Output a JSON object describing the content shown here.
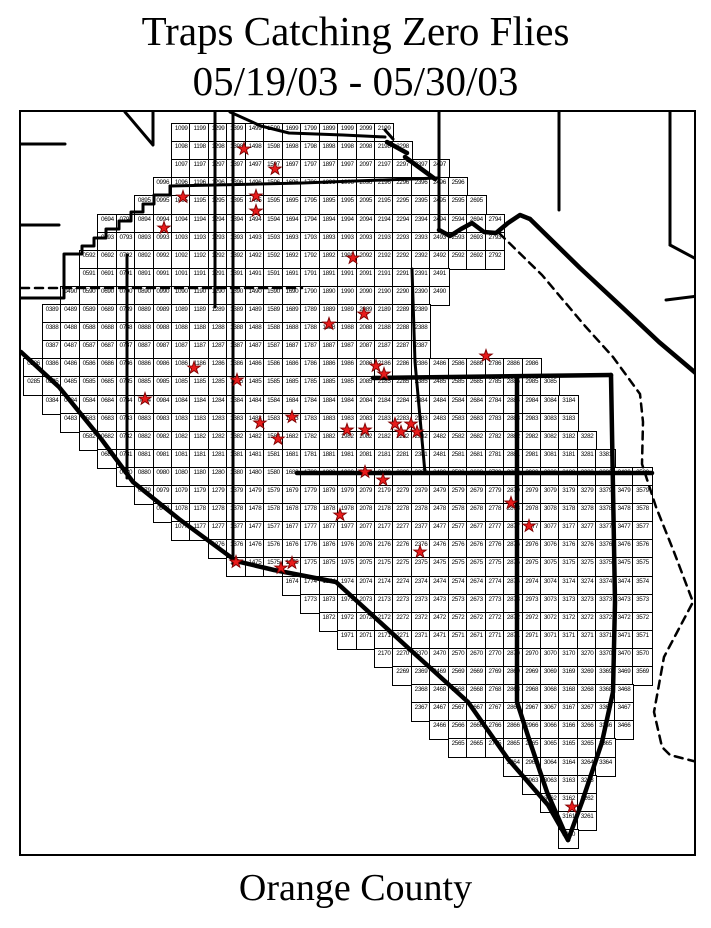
{
  "title": {
    "line1": "Traps Catching Zero Flies",
    "line2": "05/19/03 - 05/30/03"
  },
  "footer": {
    "county_label": "Orange County"
  },
  "colors": {
    "background": "#ffffff",
    "line": "#000000",
    "cell_border": "#000000",
    "star_fill": "#e81b1b",
    "star_stroke": "#7e0000"
  },
  "map": {
    "grid": {
      "rows": [
        {
          "row": 99,
          "col_start": 10,
          "col_end": 21
        },
        {
          "row": 98,
          "col_start": 10,
          "col_end": 22
        },
        {
          "row": 97,
          "col_start": 10,
          "col_end": 24
        },
        {
          "row": 96,
          "col_start": 9,
          "col_end": 25
        },
        {
          "row": 95,
          "col_start": 8,
          "col_end": 26
        },
        {
          "row": 94,
          "col_start": 6,
          "col_end": 27
        },
        {
          "row": 93,
          "col_start": 6,
          "col_end": 27
        },
        {
          "row": 92,
          "col_start": 5,
          "col_end": 27
        },
        {
          "row": 91,
          "col_start": 5,
          "col_end": 24
        },
        {
          "row": 90,
          "col_start": 4,
          "col_end": 24
        },
        {
          "row": 89,
          "col_start": 3,
          "col_end": 23
        },
        {
          "row": 88,
          "col_start": 3,
          "col_end": 23
        },
        {
          "row": 87,
          "col_start": 3,
          "col_end": 23
        },
        {
          "row": 86,
          "col_start": 2,
          "col_end": 29
        },
        {
          "row": 85,
          "col_start": 2,
          "col_end": 30
        },
        {
          "row": 84,
          "col_start": 3,
          "col_end": 31
        },
        {
          "row": 83,
          "col_start": 4,
          "col_end": 31
        },
        {
          "row": 82,
          "col_start": 5,
          "col_end": 32
        },
        {
          "row": 81,
          "col_start": 6,
          "col_end": 33
        },
        {
          "row": 80,
          "col_start": 7,
          "col_end": 35
        },
        {
          "row": 79,
          "col_start": 8,
          "col_end": 35
        },
        {
          "row": 78,
          "col_start": 9,
          "col_end": 35
        },
        {
          "row": 77,
          "col_start": 10,
          "col_end": 35
        },
        {
          "row": 76,
          "col_start": 12,
          "col_end": 35
        },
        {
          "row": 75,
          "col_start": 13,
          "col_end": 35
        },
        {
          "row": 74,
          "col_start": 16,
          "col_end": 35
        },
        {
          "row": 73,
          "col_start": 17,
          "col_end": 35
        },
        {
          "row": 72,
          "col_start": 18,
          "col_end": 35
        },
        {
          "row": 71,
          "col_start": 19,
          "col_end": 35
        },
        {
          "row": 70,
          "col_start": 21,
          "col_end": 35
        },
        {
          "row": 69,
          "col_start": 22,
          "col_end": 35
        },
        {
          "row": 68,
          "col_start": 23,
          "col_end": 34
        },
        {
          "row": 67,
          "col_start": 23,
          "col_end": 34
        },
        {
          "row": 66,
          "col_start": 24,
          "col_end": 34
        },
        {
          "row": 65,
          "col_start": 25,
          "col_end": 33
        },
        {
          "row": 64,
          "col_start": 28,
          "col_end": 33
        },
        {
          "row": 63,
          "col_start": 29,
          "col_end": 32
        },
        {
          "row": 62,
          "col_start": 30,
          "col_end": 32
        },
        {
          "row": 61,
          "col_start": 31,
          "col_end": 32
        },
        {
          "row": 60,
          "col_start": 31,
          "col_end": 31
        }
      ]
    },
    "zero_fly_traps": [
      {
        "cell": "1398",
        "x": 223,
        "y": 37
      },
      {
        "cell": "1597",
        "x": 254,
        "y": 57
      },
      {
        "cell": "1095",
        "x": 162,
        "y": 85
      },
      {
        "cell": "1495",
        "x": 235,
        "y": 84
      },
      {
        "cell": "1494",
        "x": 235,
        "y": 99
      },
      {
        "cell": "0994",
        "x": 143,
        "y": 116
      },
      {
        "cell": "1992",
        "x": 332,
        "y": 146
      },
      {
        "cell": "2089",
        "x": 343,
        "y": 202
      },
      {
        "cell": "1888",
        "x": 308,
        "y": 212
      },
      {
        "cell": "1186",
        "x": 173,
        "y": 256
      },
      {
        "cell": "2186",
        "x": 355,
        "y": 254
      },
      {
        "cell": "2186",
        "x": 363,
        "y": 262
      },
      {
        "cell": "2786",
        "x": 465,
        "y": 244
      },
      {
        "cell": "1385",
        "x": 216,
        "y": 268
      },
      {
        "cell": "0884",
        "x": 124,
        "y": 287
      },
      {
        "cell": "1583",
        "x": 239,
        "y": 311
      },
      {
        "cell": "1683",
        "x": 271,
        "y": 305
      },
      {
        "cell": "1983",
        "x": 326,
        "y": 318
      },
      {
        "cell": "2083",
        "x": 344,
        "y": 318
      },
      {
        "cell": "2283",
        "x": 374,
        "y": 312
      },
      {
        "cell": "2283",
        "x": 380,
        "y": 320
      },
      {
        "cell": "2383",
        "x": 390,
        "y": 312
      },
      {
        "cell": "2383",
        "x": 396,
        "y": 320
      },
      {
        "cell": "1582",
        "x": 257,
        "y": 327
      },
      {
        "cell": "2080",
        "x": 344,
        "y": 360
      },
      {
        "cell": "2180",
        "x": 362,
        "y": 368
      },
      {
        "cell": "1978",
        "x": 319,
        "y": 403
      },
      {
        "cell": "2879",
        "x": 490,
        "y": 391
      },
      {
        "cell": "2977",
        "x": 508,
        "y": 414
      },
      {
        "cell": "2376",
        "x": 399,
        "y": 440
      },
      {
        "cell": "1375",
        "x": 215,
        "y": 450
      },
      {
        "cell": "1575",
        "x": 260,
        "y": 456
      },
      {
        "cell": "1675",
        "x": 271,
        "y": 451
      },
      {
        "cell": "3162",
        "x": 551,
        "y": 695
      }
    ],
    "boundaries": [
      {
        "name": "top-left-diagonal",
        "type": "medium",
        "points": [
          [
            104,
            0
          ],
          [
            132,
            33
          ]
        ]
      },
      {
        "name": "top-left-vertical",
        "type": "medium",
        "points": [
          [
            132,
            0
          ],
          [
            132,
            32
          ]
        ]
      },
      {
        "name": "west-city-line-1",
        "type": "medium",
        "points": [
          [
            0,
            32
          ],
          [
            44,
            32
          ]
        ]
      },
      {
        "name": "west-city-line-2",
        "type": "medium",
        "points": [
          [
            0,
            113
          ],
          [
            38,
            113
          ]
        ]
      },
      {
        "name": "road-diagonal-top",
        "type": "medium",
        "points": [
          [
            209,
            0
          ],
          [
            240,
            14
          ],
          [
            268,
            21
          ],
          [
            322,
            23
          ],
          [
            364,
            25
          ]
        ]
      },
      {
        "name": "road-hook",
        "type": "medium",
        "points": [
          [
            364,
            18
          ],
          [
            372,
            27
          ]
        ]
      },
      {
        "name": "arrow-diagonal",
        "type": "thick",
        "points": [
          [
            366,
            30
          ],
          [
            386,
            41
          ]
        ]
      },
      {
        "name": "arrow-diagonal-2",
        "type": "thick",
        "points": [
          [
            384,
            45
          ],
          [
            414,
            67
          ]
        ]
      },
      {
        "name": "vertical-213",
        "type": "medium",
        "points": [
          [
            194,
            0
          ],
          [
            194,
            195
          ]
        ]
      },
      {
        "name": "vertical-228",
        "type": "medium",
        "points": [
          [
            212,
            0
          ],
          [
            212,
            452
          ]
        ]
      },
      {
        "name": "vertical-125",
        "type": "medium",
        "points": [
          [
            106,
            143
          ],
          [
            106,
            366
          ]
        ]
      },
      {
        "name": "vertical-437",
        "type": "medium",
        "points": [
          [
            418,
            0
          ],
          [
            418,
            118
          ]
        ]
      },
      {
        "name": "vertical-557",
        "type": "medium",
        "points": [
          [
            538,
            0
          ],
          [
            538,
            98
          ]
        ]
      },
      {
        "name": "vertical-668",
        "type": "medium",
        "points": [
          [
            649,
            0
          ],
          [
            649,
            133
          ]
        ]
      },
      {
        "name": "ne-fork",
        "type": "medium",
        "points": [
          [
            649,
            133
          ],
          [
            677,
            148
          ]
        ]
      },
      {
        "name": "ne-horizontal",
        "type": "medium",
        "points": [
          [
            645,
            188
          ],
          [
            677,
            184
          ]
        ]
      },
      {
        "name": "row96-boundary",
        "type": "medium",
        "points": [
          [
            149,
            74
          ],
          [
            281,
            71
          ],
          [
            416,
            66
          ]
        ]
      },
      {
        "name": "northwest-staircase",
        "type": "medium",
        "points": [
          [
            149,
            74
          ],
          [
            149,
            83
          ],
          [
            133,
            83
          ],
          [
            133,
            92
          ],
          [
            122,
            92
          ],
          [
            122,
            100
          ],
          [
            110,
            100
          ],
          [
            110,
            109
          ],
          [
            98,
            109
          ],
          [
            98,
            117
          ],
          [
            85,
            117
          ],
          [
            85,
            126
          ],
          [
            73,
            126
          ],
          [
            73,
            134
          ],
          [
            61,
            134
          ],
          [
            61,
            142
          ],
          [
            43,
            142
          ],
          [
            43,
            186
          ],
          [
            0,
            186
          ]
        ]
      },
      {
        "name": "wiggle-northeast",
        "type": "thick",
        "points": [
          [
            418,
            118
          ],
          [
            429,
            124
          ],
          [
            440,
            117
          ],
          [
            451,
            111
          ],
          [
            463,
            120
          ],
          [
            475,
            121
          ],
          [
            487,
            111
          ],
          [
            499,
            103
          ],
          [
            509,
            107
          ]
        ]
      },
      {
        "name": "mountain-diagonal",
        "type": "thick",
        "points": [
          [
            509,
            107
          ],
          [
            559,
            156
          ],
          [
            603,
            197
          ],
          [
            638,
            230
          ],
          [
            677,
            263
          ]
        ]
      },
      {
        "name": "coastline",
        "type": "thick",
        "points": [
          [
            0,
            240
          ],
          [
            38,
            275
          ],
          [
            81,
            328
          ],
          [
            112,
            370
          ],
          [
            158,
            407
          ],
          [
            215,
            449
          ],
          [
            253,
            458
          ],
          [
            315,
            470
          ],
          [
            384,
            533
          ],
          [
            447,
            590
          ],
          [
            487,
            647
          ],
          [
            527,
            693
          ],
          [
            547,
            728
          ]
        ]
      },
      {
        "name": "east-boundary",
        "type": "thick",
        "points": [
          [
            590,
            263
          ],
          [
            594,
            490
          ],
          [
            592,
            580
          ],
          [
            581,
            630
          ],
          [
            561,
            690
          ],
          [
            547,
            728
          ]
        ]
      },
      {
        "name": "row85-boundary",
        "type": "thick",
        "points": [
          [
            352,
            266
          ],
          [
            590,
            263
          ]
        ]
      },
      {
        "name": "mid-vertical-515",
        "type": "thick",
        "points": [
          [
            496,
            266
          ],
          [
            496,
            590
          ],
          [
            508,
            627
          ],
          [
            526,
            680
          ],
          [
            547,
            728
          ]
        ]
      },
      {
        "name": "row80-boundary",
        "type": "thick",
        "points": [
          [
            276,
            361
          ],
          [
            631,
            361
          ]
        ]
      },
      {
        "name": "vertical-410",
        "type": "medium",
        "points": [
          [
            391,
            157
          ],
          [
            394,
            250
          ],
          [
            404,
            361
          ]
        ]
      },
      {
        "name": "dashed-southeast",
        "type": "dashed",
        "points": [
          [
            478,
            121
          ],
          [
            521,
            163
          ],
          [
            564,
            214
          ],
          [
            592,
            245
          ],
          [
            619,
            282
          ],
          [
            622,
            310
          ],
          [
            621,
            352
          ],
          [
            635,
            395
          ],
          [
            653,
            440
          ],
          [
            672,
            490
          ],
          [
            643,
            545
          ],
          [
            633,
            600
          ],
          [
            641,
            635
          ],
          [
            649,
            643
          ],
          [
            676,
            650
          ]
        ]
      },
      {
        "name": "dashed-row91",
        "type": "dashed",
        "points": [
          [
            0,
            176
          ],
          [
            281,
            176
          ]
        ]
      }
    ]
  }
}
